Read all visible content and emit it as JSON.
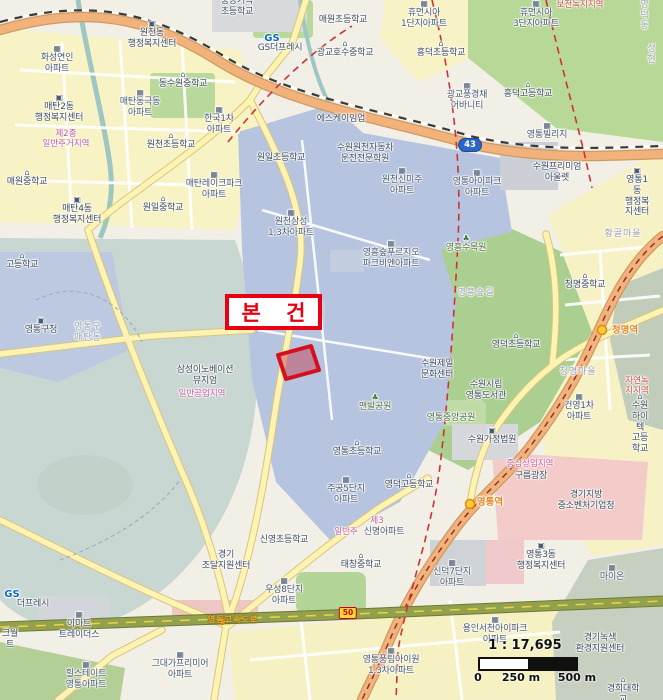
{
  "map": {
    "subject_label": "본 건",
    "scale": {
      "ratio": "1 : 17,695",
      "ticks": [
        "0",
        "250 m",
        "500 m"
      ]
    },
    "colors": {
      "subject_red": "#e60012",
      "parcel_fill": "#c6445a",
      "zone_residential_text": "#c4569a",
      "zone_green_text": "#cc4f44",
      "station_text": "#e6851e",
      "road_major": "#f2b27b",
      "expressway": "#94a14c",
      "lake": "#c9d7d3",
      "district_blue": "#b6c4df"
    },
    "route_shields": [
      {
        "t": "43",
        "x": 470,
        "y": 145,
        "kind": "national"
      },
      {
        "t": "50",
        "x": 348,
        "y": 613,
        "kind": "expressway"
      }
    ],
    "labels": [
      {
        "t": "중앙기독\n초등학교",
        "x": 237,
        "y": -4,
        "c": "school"
      },
      {
        "t": "보전녹지지역",
        "x": 580,
        "y": 0,
        "c": "zone-green"
      },
      {
        "t": "영 덕 동",
        "x": 645,
        "y": 0,
        "c": "area"
      },
      {
        "t": "휴먼시아\n1단지아파트",
        "x": 424,
        "y": 0,
        "c": "apt",
        "i": "apt"
      },
      {
        "t": "휴먼시아\n3단지아파트",
        "x": 536,
        "y": 0,
        "c": "apt",
        "i": "apt"
      },
      {
        "t": "매원초등학교",
        "x": 343,
        "y": 15,
        "c": "school"
      },
      {
        "t": "원천동\n행정복지센터",
        "x": 152,
        "y": 20,
        "c": "gov",
        "i": "gov"
      },
      {
        "t": "GS",
        "x": 272,
        "y": 33,
        "c": "gs"
      },
      {
        "t": "GS더프레시",
        "x": 280,
        "y": 43,
        "c": "shop"
      },
      {
        "t": "광교호수중학교",
        "x": 345,
        "y": 40,
        "c": "school",
        "i": "school"
      },
      {
        "t": "성현",
        "x": 652,
        "y": 44,
        "c": "area"
      },
      {
        "t": "흥덕초등학교",
        "x": 441,
        "y": 40,
        "c": "school",
        "i": "school"
      },
      {
        "t": "화성연인\n아파트",
        "x": 57,
        "y": 45,
        "c": "apt",
        "i": "apt"
      },
      {
        "t": "동수원중학교",
        "x": 183,
        "y": 71,
        "c": "school",
        "i": "school"
      },
      {
        "t": "광교풍경채\n어바니티",
        "x": 467,
        "y": 82,
        "c": "apt",
        "i": "apt"
      },
      {
        "t": "흥덕고등학교",
        "x": 528,
        "y": 81,
        "c": "school",
        "i": "school"
      },
      {
        "t": "매탄동극동\n아파트",
        "x": 140,
        "y": 89,
        "c": "apt",
        "i": "apt"
      },
      {
        "t": "매탄2동\n행정복지센터",
        "x": 59,
        "y": 94,
        "c": "gov",
        "i": "gov"
      },
      {
        "t": "한국1차\n아파트",
        "x": 219,
        "y": 106,
        "c": "apt",
        "i": "apt"
      },
      {
        "t": "에스케이임업",
        "x": 341,
        "y": 114,
        "c": "fac"
      },
      {
        "t": "영통빌리지",
        "x": 547,
        "y": 122,
        "c": "apt",
        "i": "apt"
      },
      {
        "t": "제2종\n일반주거지역",
        "x": 66,
        "y": 129,
        "c": "zone-res"
      },
      {
        "t": "원천초등학교",
        "x": 171,
        "y": 132,
        "c": "school",
        "i": "school"
      },
      {
        "t": "수원원천자동차\n운전전문학원",
        "x": 365,
        "y": 143,
        "c": "fac"
      },
      {
        "t": "원일초등학교",
        "x": 281,
        "y": 153,
        "c": "school"
      },
      {
        "t": "수원프리미엄\n아울렛",
        "x": 557,
        "y": 162,
        "c": "fac"
      },
      {
        "t": "매탄레이크파크\n아파트",
        "x": 214,
        "y": 171,
        "c": "apt",
        "i": "apt"
      },
      {
        "t": "원천신미주\n아파트",
        "x": 402,
        "y": 167,
        "c": "apt",
        "i": "apt"
      },
      {
        "t": "영통아이파크\n아파트",
        "x": 477,
        "y": 169,
        "c": "apt",
        "i": "apt"
      },
      {
        "t": "매원중학교",
        "x": 27,
        "y": 169,
        "c": "school",
        "i": "school"
      },
      {
        "t": "영통1동\n행정복지센터",
        "x": 637,
        "y": 167,
        "c": "gov",
        "i": "gov"
      },
      {
        "t": "매탄4동\n행정복지센터",
        "x": 77,
        "y": 196,
        "c": "gov",
        "i": "gov"
      },
      {
        "t": "원일중학교",
        "x": 163,
        "y": 195,
        "c": "school",
        "i": "school"
      },
      {
        "t": "원천삼성\n1,3차아파트",
        "x": 291,
        "y": 209,
        "c": "apt",
        "i": "apt"
      },
      {
        "t": "황골마을",
        "x": 623,
        "y": 229,
        "c": "area"
      },
      {
        "t": "영흥수목원",
        "x": 466,
        "y": 235,
        "c": "park",
        "i": "park"
      },
      {
        "t": "영흥숲푸르지오\n파크비엔아파트",
        "x": 391,
        "y": 240,
        "c": "apt",
        "i": "apt"
      },
      {
        "t": "고등학교",
        "x": 22,
        "y": 252,
        "c": "school",
        "i": "school"
      },
      {
        "t": "청명중학교",
        "x": 585,
        "y": 272,
        "c": "school",
        "i": "school"
      },
      {
        "t": "영흥숲길",
        "x": 476,
        "y": 288,
        "c": "area"
      },
      {
        "t": "청명역",
        "x": 625,
        "y": 325,
        "c": "station"
      },
      {
        "t": "영통구\n매탄동",
        "x": 88,
        "y": 322,
        "c": "area"
      },
      {
        "t": "영통구청",
        "x": 41,
        "y": 317,
        "c": "gov",
        "i": "gov"
      },
      {
        "t": "영덕초등학교",
        "x": 516,
        "y": 332,
        "c": "school",
        "i": "school"
      },
      {
        "t": "수원제일\n문화센터",
        "x": 437,
        "y": 359,
        "c": "fac"
      },
      {
        "t": "청명마을",
        "x": 578,
        "y": 367,
        "c": "area"
      },
      {
        "t": "삼성이노베이션\n뮤지엄",
        "x": 205,
        "y": 365,
        "c": "fac"
      },
      {
        "t": "자연녹지지역",
        "x": 637,
        "y": 376,
        "c": "zone-green"
      },
      {
        "t": "수원시립\n영통도서관",
        "x": 486,
        "y": 380,
        "c": "fac"
      },
      {
        "t": "일반공업지역",
        "x": 202,
        "y": 389,
        "c": "zone-res"
      },
      {
        "t": "맨발공원",
        "x": 375,
        "y": 394,
        "c": "park",
        "i": "park"
      },
      {
        "t": "건영1차\n아파트",
        "x": 579,
        "y": 393,
        "c": "apt",
        "i": "apt"
      },
      {
        "t": "수원하이텍\n고등학교",
        "x": 640,
        "y": 393,
        "c": "school",
        "i": "school"
      },
      {
        "t": "영통중앙공원",
        "x": 451,
        "y": 413,
        "c": "park"
      },
      {
        "t": "수원가정법원",
        "x": 492,
        "y": 427,
        "c": "gov",
        "i": "gov"
      },
      {
        "t": "영통초등학교",
        "x": 357,
        "y": 439,
        "c": "school",
        "i": "school"
      },
      {
        "t": "중심상업지역",
        "x": 530,
        "y": 459,
        "c": "zone-res"
      },
      {
        "t": "구름광장",
        "x": 531,
        "y": 471,
        "c": "fac"
      },
      {
        "t": "영덕고등학교",
        "x": 409,
        "y": 472,
        "c": "school",
        "i": "school"
      },
      {
        "t": "주공5단지\n아파트",
        "x": 346,
        "y": 476,
        "c": "apt",
        "i": "apt"
      },
      {
        "t": "경기지방\n중소벤처기업청",
        "x": 586,
        "y": 490,
        "c": "gov"
      },
      {
        "t": "영통역",
        "x": 490,
        "y": 497,
        "c": "station"
      },
      {
        "t": "제3",
        "x": 377,
        "y": 516,
        "c": "zone-res"
      },
      {
        "t": "일반주",
        "x": 346,
        "y": 527,
        "c": "zone-res"
      },
      {
        "t": "신명아파트",
        "x": 384,
        "y": 527,
        "c": "apt"
      },
      {
        "t": "신영초등학교",
        "x": 284,
        "y": 535,
        "c": "school"
      },
      {
        "t": "경기\n조달지원센터",
        "x": 226,
        "y": 550,
        "c": "gov"
      },
      {
        "t": "영통3동\n행정복지센터",
        "x": 541,
        "y": 542,
        "c": "gov",
        "i": "gov"
      },
      {
        "t": "태창중학교",
        "x": 361,
        "y": 552,
        "c": "school",
        "i": "school"
      },
      {
        "t": "신덕7단지\n아파트",
        "x": 452,
        "y": 559,
        "c": "apt",
        "i": "apt"
      },
      {
        "t": "마이온",
        "x": 612,
        "y": 564,
        "c": "apt",
        "i": "apt"
      },
      {
        "t": "우성8단지\n아파트",
        "x": 284,
        "y": 577,
        "c": "apt",
        "i": "apt"
      },
      {
        "t": "GS",
        "x": 12,
        "y": 589,
        "c": "gs"
      },
      {
        "t": "더프레시",
        "x": 33,
        "y": 599,
        "c": "shop"
      },
      {
        "t": "영동고속도로",
        "x": 233,
        "y": 615,
        "c": "hwy-name"
      },
      {
        "t": "이마트\n트레이더스",
        "x": 79,
        "y": 611,
        "c": "shop",
        "i": "apt"
      },
      {
        "t": "크월\n트",
        "x": 10,
        "y": 629,
        "c": "fac"
      },
      {
        "t": "용인서천아이파크\n아파트",
        "x": 495,
        "y": 616,
        "c": "apt",
        "i": "apt"
      },
      {
        "t": "경기녹색\n환경지원센터",
        "x": 600,
        "y": 633,
        "c": "fac"
      },
      {
        "t": "힐스테이트\n영통아파트",
        "x": 86,
        "y": 661,
        "c": "apt",
        "i": "apt"
      },
      {
        "t": "그대가프리미어\n아파트",
        "x": 180,
        "y": 651,
        "c": "apt",
        "i": "apt"
      },
      {
        "t": "영통풍림아이원\n1,3차아파트",
        "x": 391,
        "y": 647,
        "c": "apt",
        "i": "apt"
      },
      {
        "t": "경희대학교",
        "x": 623,
        "y": 676,
        "c": "school",
        "i": "school"
      }
    ]
  }
}
